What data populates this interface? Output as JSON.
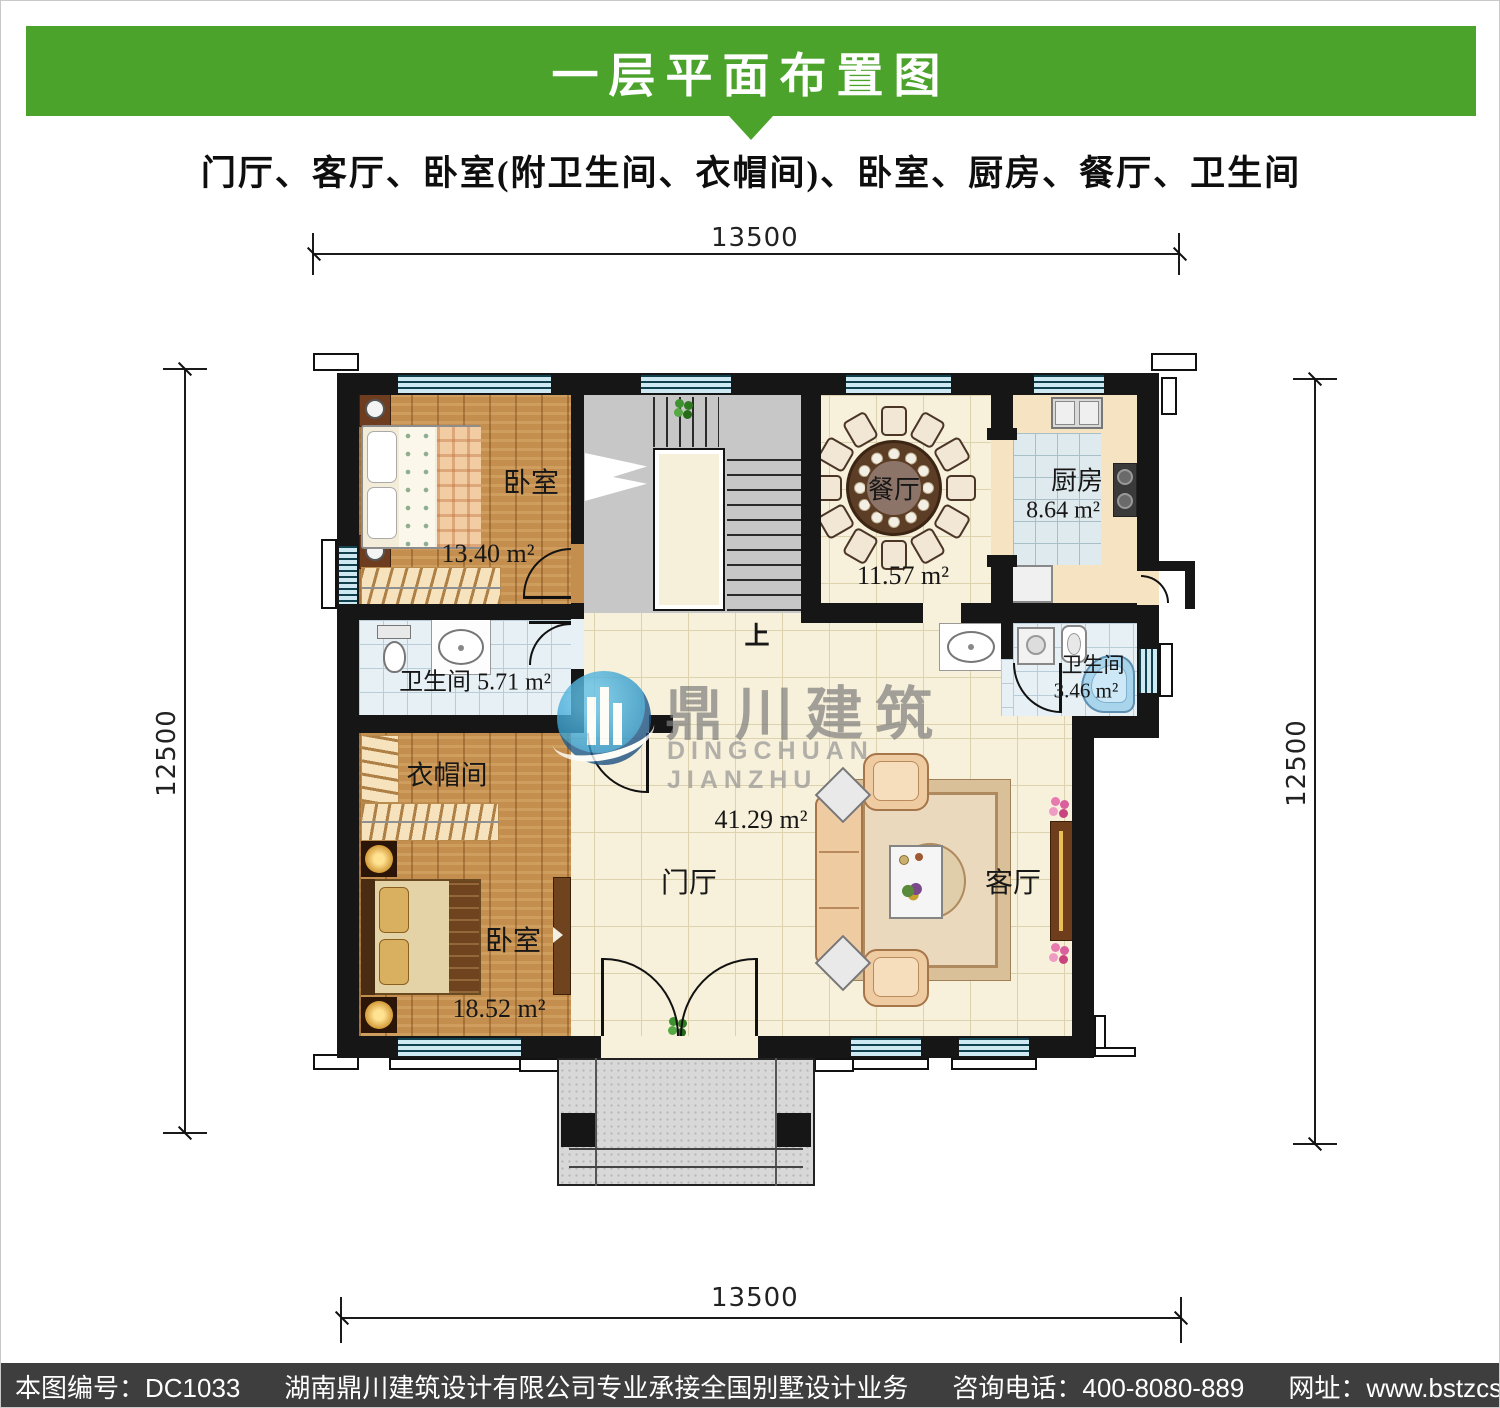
{
  "page": {
    "title": "一层平面布置图",
    "subtitle": "门厅、客厅、卧室(附卫生间、衣帽间)、卧室、厨房、餐厅、卫生间"
  },
  "dimensions": {
    "top": "13500",
    "bottom": "13500",
    "left": "12500",
    "right": "12500"
  },
  "rooms": {
    "bedroom1": {
      "name": "卧室",
      "area": "13.40 m²"
    },
    "bathroom1": {
      "name": "卫生间",
      "area": "5.71 m²"
    },
    "cloakroom": {
      "name": "衣帽间"
    },
    "bedroom2": {
      "name": "卧室",
      "area": "18.52 m²"
    },
    "hall": {
      "name": "门厅",
      "area": "41.29 m²"
    },
    "living": {
      "name": "客厅"
    },
    "dining": {
      "name": "餐厅",
      "area": "11.57 m²"
    },
    "kitchen": {
      "name": "厨房",
      "area": "8.64 m²"
    },
    "bathroom2": {
      "name": "卫生间",
      "area": "3.46 m²"
    }
  },
  "stairs": {
    "up": "上"
  },
  "watermark": {
    "cn": "鼎川建筑",
    "en": "DINGCHUAN JIANZHU"
  },
  "footer": {
    "sheet_no": "本图编号：DC1033",
    "company": "湖南鼎川建筑设计有限公司专业承接全国别墅设计业务",
    "phone": "咨询电话：400-8080-889",
    "website": "网址：www.bstzcs.com"
  },
  "colors": {
    "header_green": "#4ba32c",
    "footer_gray": "#3e3e3e",
    "wall_black": "#161616",
    "window_blue": "#cfe9f2"
  }
}
